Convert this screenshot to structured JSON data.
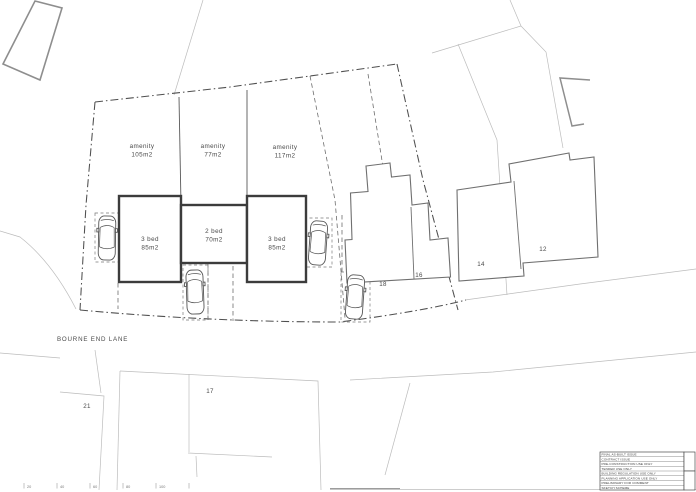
{
  "colors": {
    "paper": "#ffffff",
    "ink_dark": "#3c3c3c",
    "ink_mid": "#8e8e8e",
    "ink_light": "#bcbcbc"
  },
  "site": {
    "road_label": "BOURNE END LANE",
    "plots": [
      {
        "id": "plot1",
        "amenity_line1": "amenity",
        "amenity_line2": "105m2",
        "house_line1": "3 bed",
        "house_line2": "85m2"
      },
      {
        "id": "plot2",
        "amenity_line1": "amenity",
        "amenity_line2": "77m2",
        "house_line1": "2 bed",
        "house_line2": "70m2"
      },
      {
        "id": "plot3",
        "amenity_line1": "amenity",
        "amenity_line2": "117m2",
        "house_line1": "3 bed",
        "house_line2": "85m2"
      }
    ],
    "neighbor_labels": {
      "h18": "18",
      "h16": "16",
      "h14": "14",
      "h12": "12",
      "h21": "21",
      "h17": "17"
    },
    "scale_ticks": [
      "20",
      "40",
      "60",
      "80",
      "100"
    ],
    "title_block_rows": [
      "FINAL AS-BUILT ISSUE",
      "CONTRACT ISSUE",
      "PRE-CONSTRUCTION USE ONLY",
      "TENDER USE ONLY",
      "BUILDING REGULATION USE ONLY",
      "PLANNING APPLICATION USE ONLY",
      "PRELIMINARY FOR COMMENT",
      "SKETCH SCHEME"
    ]
  }
}
